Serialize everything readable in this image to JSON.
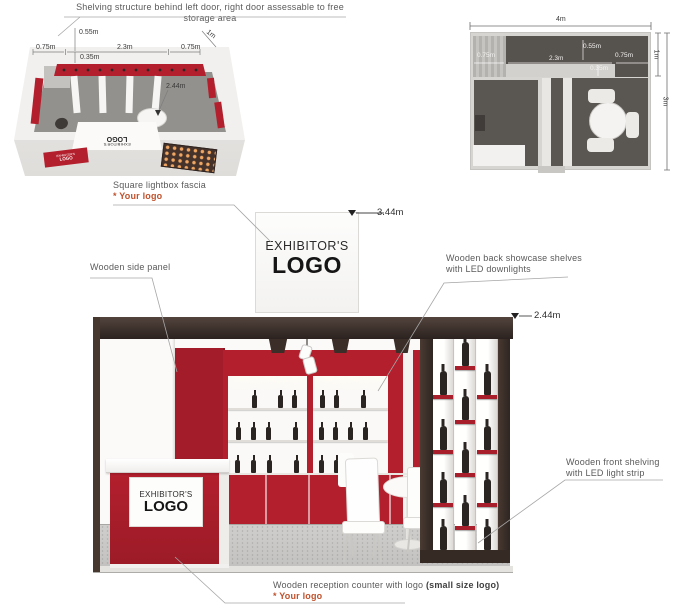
{
  "branding": {
    "name": "EXHIBITOR'S",
    "logo": "LOGO"
  },
  "annotations": {
    "top_note": "Shelving structure behind left door, right door assessable to free storage area",
    "lightbox_title": "Square lightbox fascia",
    "lightbox_note": "* Your logo",
    "side_panel": "Wooden side panel",
    "back_shelves_line1": "Wooden back showcase shelves",
    "back_shelves_line2": "with LED downlights",
    "front_shelving_line1": "Wooden front shelving",
    "front_shelving_line2": "with LED light strip",
    "reception_text": "Wooden reception counter with logo ",
    "reception_bold": "(small size logo)",
    "reception_note": "* Your logo"
  },
  "dimensions": {
    "d055": "0.55m",
    "d075": "0.75m",
    "d23": "2.3m",
    "d1": "1m",
    "d035": "0.35m",
    "d244": "2.44m",
    "d344": "3.44m",
    "d4": "4m",
    "d3": "3m"
  },
  "colors": {
    "red": "#b31f2d",
    "red_dark": "#a31c29",
    "frame_brown": "#382c26",
    "accent": "#c0512c"
  }
}
